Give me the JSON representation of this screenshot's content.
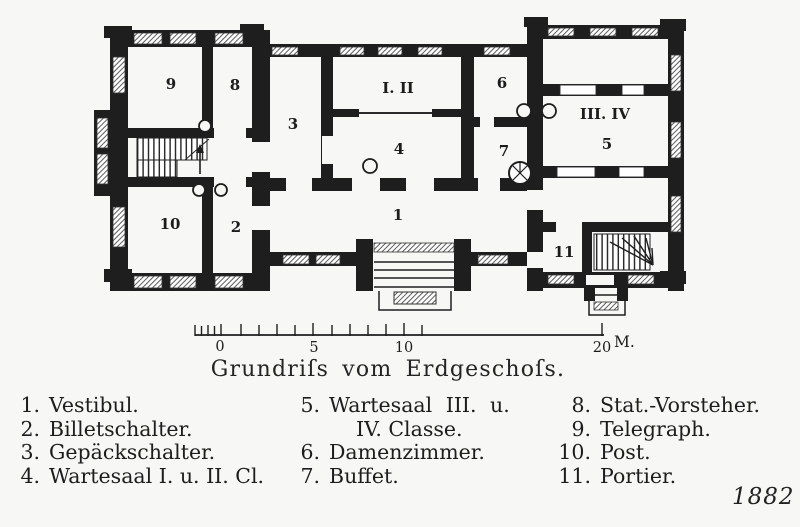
{
  "title": "Grundriſs vom Erdgeschoſs.",
  "year": "1882",
  "plan": {
    "labels": {
      "r1": "1",
      "r2": "2",
      "r3": "3",
      "r4": "4",
      "r5": "5",
      "r6": "6",
      "r7": "7",
      "r8": "8",
      "r9": "9",
      "r10": "10",
      "r11": "11",
      "class_1_2": "I. II",
      "class_3_4": "III. IV"
    }
  },
  "scale": {
    "n0": "0",
    "n5": "5",
    "n10": "10",
    "n20": "20",
    "unit": "M."
  },
  "legend": {
    "col1": [
      {
        "num": "1.",
        "text": "Vestibul."
      },
      {
        "num": "2.",
        "text": "Billetschalter."
      },
      {
        "num": "3.",
        "text": "Gepäckschalter."
      },
      {
        "num": "4.",
        "text": "Wartesaal I. u. II. Cl."
      }
    ],
    "col2": [
      {
        "num": "5.",
        "line1": "Wartesaal III. u.",
        "line2": "IV. Classe."
      },
      {
        "num": "6.",
        "text": "Damenzimmer."
      },
      {
        "num": "7.",
        "text": "Buffet."
      }
    ],
    "col3": [
      {
        "num": "8.",
        "text": "Stat.-Vorsteher."
      },
      {
        "num": "9.",
        "text": "Telegraph."
      },
      {
        "num": "10.",
        "text": "Post."
      },
      {
        "num": "11.",
        "text": "Portier."
      }
    ]
  },
  "colors": {
    "ink": "#1e1e1e",
    "paper": "#f7f7f5"
  }
}
